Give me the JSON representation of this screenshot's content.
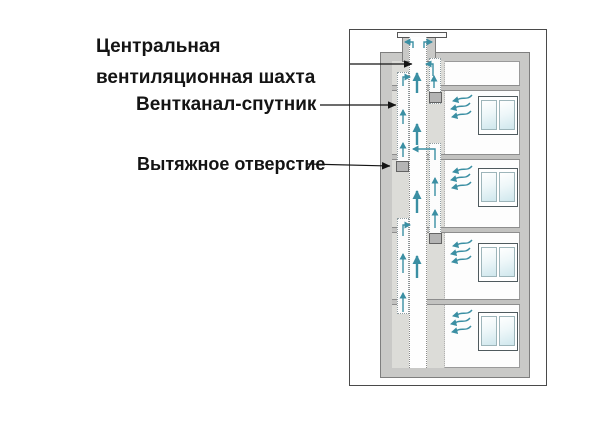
{
  "labels": {
    "central_shaft_line1": "Центральная",
    "central_shaft_line2": "вентиляционная шахта",
    "satellite_duct": "Вентканал-спутник",
    "exhaust_opening": "Вытяжное отверстие"
  },
  "diagram": {
    "type": "building-ventilation-cross-section",
    "floors": 4,
    "windows": 4,
    "exhaust_openings": 3,
    "airflow_direction": "up-and-out-through-roof-cap",
    "colors": {
      "airflow_arrow": "#3b8fa3",
      "wall_fill": "#c9c9c7",
      "shaft_strip_fill": "#dcdcd8",
      "window_glass": "#cfe7ed",
      "label_text": "#141414"
    }
  }
}
